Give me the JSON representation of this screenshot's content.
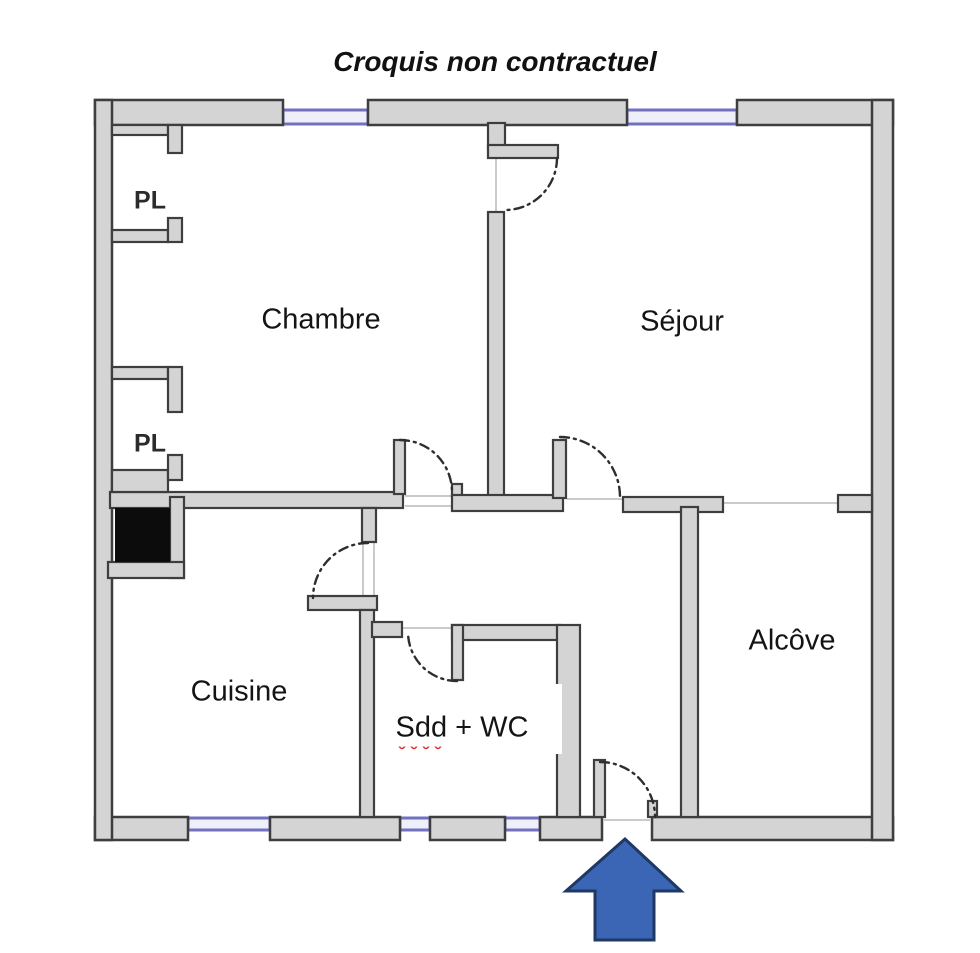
{
  "title": "Croquis non contractuel",
  "rooms": [
    {
      "id": "chambre",
      "label": "Chambre",
      "cx": 321,
      "cy": 320
    },
    {
      "id": "sejour",
      "label": "Séjour",
      "cx": 682,
      "cy": 322
    },
    {
      "id": "cuisine",
      "label": "Cuisine",
      "cx": 239,
      "cy": 692
    },
    {
      "id": "sdd-wc",
      "label": "Sdd + WC",
      "cx": 462,
      "cy": 728
    },
    {
      "id": "alcove",
      "label": "Alcôve",
      "cx": 792,
      "cy": 641
    }
  ],
  "closets": [
    {
      "id": "pl-1",
      "label": "PL",
      "cx": 150,
      "cy": 201
    },
    {
      "id": "pl-2",
      "label": "PL",
      "cx": 150,
      "cy": 444
    }
  ],
  "colors": {
    "wall_fill": "#d4d4d4",
    "wall_stroke": "#3e3e3e",
    "window_fill": "#efeffa",
    "window_stroke": "#7171c0",
    "arc_stroke": "#2e2e2e",
    "threshold": "#b9b9b9",
    "chimney_fill": "#0c0c0c",
    "arrow_fill": "#3a66b5",
    "arrow_stroke": "#1f3864",
    "spellcheck_red": "#e03030",
    "background": "#ffffff"
  },
  "floorplan": {
    "outer_walls": [
      {
        "x": 95,
        "y": 100,
        "w": 188,
        "h": 25
      },
      {
        "x": 368,
        "y": 100,
        "w": 259,
        "h": 25
      },
      {
        "x": 737,
        "y": 100,
        "w": 156,
        "h": 25
      },
      {
        "x": 95,
        "y": 817,
        "w": 93,
        "h": 23
      },
      {
        "x": 270,
        "y": 817,
        "w": 130,
        "h": 23
      },
      {
        "x": 430,
        "y": 817,
        "w": 75,
        "h": 23
      },
      {
        "x": 540,
        "y": 817,
        "w": 62,
        "h": 23
      },
      {
        "x": 652,
        "y": 817,
        "w": 241,
        "h": 23
      },
      {
        "x": 95,
        "y": 100,
        "w": 17,
        "h": 740
      },
      {
        "x": 872,
        "y": 100,
        "w": 21,
        "h": 740
      }
    ],
    "inner_walls": [
      {
        "x": 488,
        "y": 123,
        "w": 17,
        "h": 26
      },
      {
        "x": 488,
        "y": 145,
        "w": 70,
        "h": 13
      },
      {
        "x": 488,
        "y": 212,
        "w": 16,
        "h": 285
      },
      {
        "x": 110,
        "y": 492,
        "w": 293,
        "h": 16
      },
      {
        "x": 394,
        "y": 440,
        "w": 11,
        "h": 54
      },
      {
        "x": 452,
        "y": 484,
        "w": 10,
        "h": 13
      },
      {
        "x": 452,
        "y": 495,
        "w": 111,
        "h": 16
      },
      {
        "x": 553,
        "y": 440,
        "w": 13,
        "h": 58
      },
      {
        "x": 623,
        "y": 497,
        "w": 100,
        "h": 15
      },
      {
        "x": 681,
        "y": 507,
        "w": 17,
        "h": 310
      },
      {
        "x": 838,
        "y": 495,
        "w": 34,
        "h": 17
      },
      {
        "x": 170,
        "y": 497,
        "w": 14,
        "h": 81
      },
      {
        "x": 108,
        "y": 562,
        "w": 76,
        "h": 16
      },
      {
        "x": 362,
        "y": 508,
        "w": 14,
        "h": 34
      },
      {
        "x": 308,
        "y": 596,
        "w": 69,
        "h": 14
      },
      {
        "x": 360,
        "y": 610,
        "w": 14,
        "h": 207
      },
      {
        "x": 372,
        "y": 622,
        "w": 30,
        "h": 15
      },
      {
        "x": 452,
        "y": 625,
        "w": 108,
        "h": 15
      },
      {
        "x": 452,
        "y": 625,
        "w": 11,
        "h": 55
      },
      {
        "x": 557,
        "y": 625,
        "w": 23,
        "h": 192
      },
      {
        "x": 594,
        "y": 760,
        "w": 11,
        "h": 57
      },
      {
        "x": 648,
        "y": 801,
        "w": 9,
        "h": 16
      },
      {
        "x": 112,
        "y": 125,
        "w": 56,
        "h": 10
      },
      {
        "x": 168,
        "y": 125,
        "w": 14,
        "h": 28
      },
      {
        "x": 112,
        "y": 230,
        "w": 56,
        "h": 12
      },
      {
        "x": 168,
        "y": 218,
        "w": 14,
        "h": 24
      },
      {
        "x": 112,
        "y": 367,
        "w": 56,
        "h": 12
      },
      {
        "x": 168,
        "y": 367,
        "w": 14,
        "h": 45
      },
      {
        "x": 112,
        "y": 470,
        "w": 56,
        "h": 22
      },
      {
        "x": 168,
        "y": 455,
        "w": 14,
        "h": 25
      }
    ],
    "windows": [
      {
        "x": 283,
        "y": 110,
        "w": 85,
        "h": 14
      },
      {
        "x": 627,
        "y": 110,
        "w": 110,
        "h": 14
      },
      {
        "x": 188,
        "y": 818,
        "w": 82,
        "h": 12
      },
      {
        "x": 400,
        "y": 818,
        "w": 30,
        "h": 12
      },
      {
        "x": 505,
        "y": 818,
        "w": 35,
        "h": 12
      }
    ],
    "thresholds": [
      {
        "x1": 496,
        "y1": 158,
        "x2": 496,
        "y2": 212
      },
      {
        "x1": 405,
        "y1": 496,
        "x2": 452,
        "y2": 496
      },
      {
        "x1": 405,
        "y1": 506,
        "x2": 452,
        "y2": 506
      },
      {
        "x1": 567,
        "y1": 499,
        "x2": 623,
        "y2": 499
      },
      {
        "x1": 363,
        "y1": 540,
        "x2": 363,
        "y2": 598
      },
      {
        "x1": 374,
        "y1": 540,
        "x2": 374,
        "y2": 598
      },
      {
        "x1": 402,
        "y1": 628,
        "x2": 452,
        "y2": 628
      },
      {
        "x1": 604,
        "y1": 820,
        "x2": 650,
        "y2": 820
      },
      {
        "x1": 723,
        "y1": 503,
        "x2": 838,
        "y2": 503
      }
    ],
    "door_arcs": [
      {
        "d": "M 557 158 A 52 52 0 0 1 505 210"
      },
      {
        "d": "M 400 440 A 52 52 0 0 1 452 492"
      },
      {
        "d": "M 560 437 A 60 60 0 0 1 620 497"
      },
      {
        "d": "M 368 543 A 55 55 0 0 0 313 598"
      },
      {
        "d": "M 457 681 A 49 49 0 0 1 408 632"
      },
      {
        "d": "M 600 762 A 55 55 0 0 1 655 817"
      }
    ],
    "chimney": {
      "x": 115,
      "y": 508,
      "w": 55,
      "h": 54
    },
    "label_mask": {
      "x": 383,
      "y": 684,
      "w": 179,
      "h": 70
    },
    "spellcheck_underline": {
      "d": "M 393 746 q 3 -5 6 0 t 6 0 t 6 0 t 6 0 t 6 0 t 6 0 t 6 0 t 6 0"
    },
    "entrance_arrow": {
      "points": "625,839 566,891 595,891 595,940 654,940 654,891 681,891"
    }
  }
}
